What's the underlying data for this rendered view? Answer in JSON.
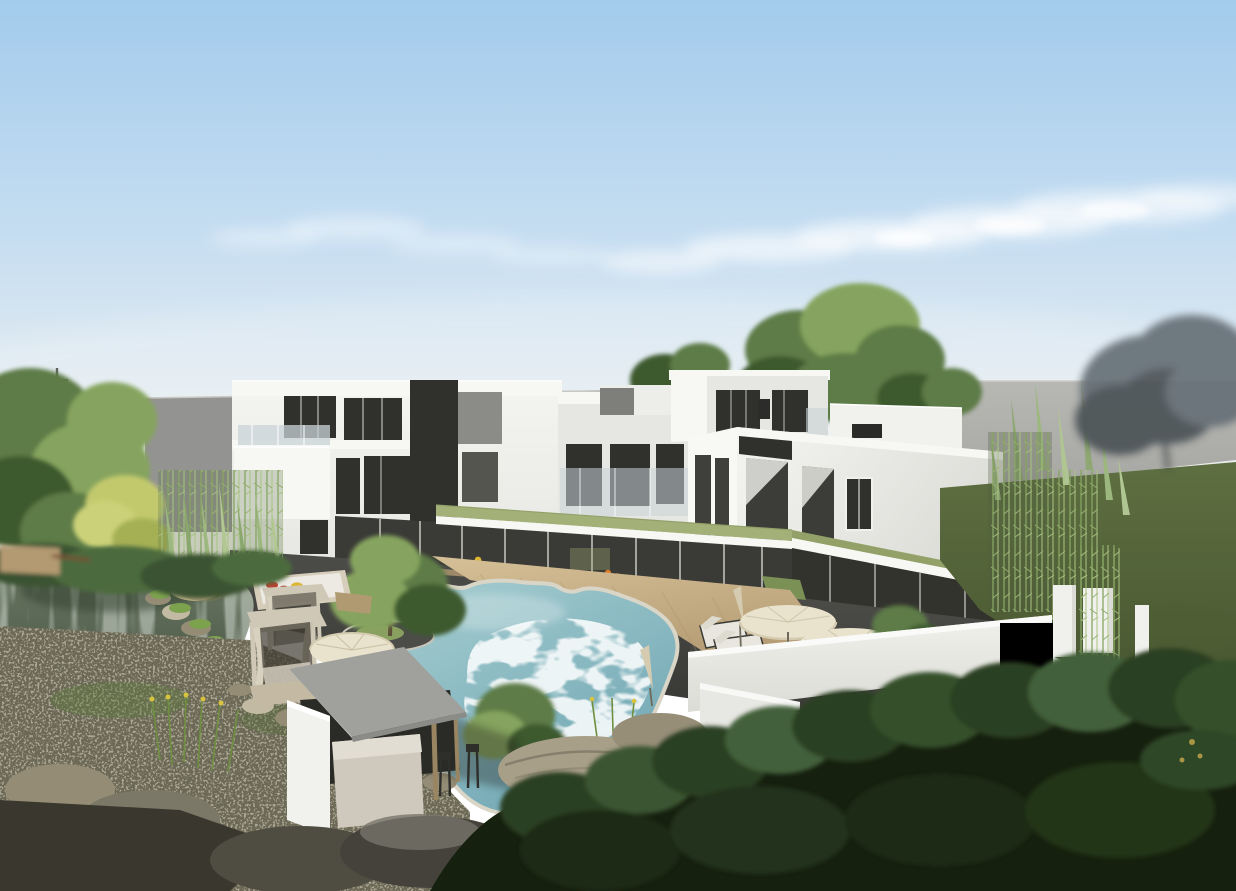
{
  "meta": {
    "kind": "architectural-rendering",
    "description": "Aerial 3D visualization of a modern white multi-wing residence around a courtyard: freeform swimming pool with wooden deck, glass colonnade with sage green roof, koi pond with rock garden at left, gazebo pool bar, cabana daybeds, cream patio umbrellas and sun loungers, white perimeter wall, dense foreground trees, gray backdrop buildings under a clear blue sky"
  },
  "scene": {
    "objects": [
      {
        "name": "sky",
        "label": "gradient blue sky"
      },
      {
        "name": "clouds",
        "label": "wispy white clouds"
      },
      {
        "name": "utility-pole",
        "label": "distant utility pole"
      },
      {
        "name": "backdrop-building-left",
        "label": "gray neighboring building"
      },
      {
        "name": "backdrop-wall-right",
        "label": "large gray boundary wall"
      },
      {
        "name": "misty-tree",
        "label": "hazy tree at far right"
      },
      {
        "name": "left-garden-trees",
        "label": "lush garden trees"
      },
      {
        "name": "yellow-accent-tree",
        "label": "yellow-green accent tree"
      },
      {
        "name": "bamboo-grove",
        "label": "bamboo grove"
      },
      {
        "name": "conifer-grove",
        "label": "slender conifers"
      },
      {
        "name": "left-wing",
        "label": "three-story white wing"
      },
      {
        "name": "penthouse",
        "label": "rooftop penthouse volume"
      },
      {
        "name": "center-block",
        "label": "recessed center block with balcony"
      },
      {
        "name": "right-wing",
        "label": "two-story white wing"
      },
      {
        "name": "glass-colonnade",
        "label": "ground-floor glass colonnade"
      },
      {
        "name": "green-roof",
        "label": "sage green walkway roof"
      },
      {
        "name": "courtyard-paving",
        "label": "dark stone paving"
      },
      {
        "name": "wood-deck",
        "label": "timber pool deck"
      },
      {
        "name": "swimming-pool",
        "label": "freeform turquoise pool"
      },
      {
        "name": "pool-island-tree",
        "label": "planted island tree in pool corner"
      },
      {
        "name": "koi-pond",
        "label": "reflective garden pond"
      },
      {
        "name": "pond-stones",
        "label": "shore stones"
      },
      {
        "name": "reeds",
        "label": "reeds with yellow blooms"
      },
      {
        "name": "stepping-stones",
        "label": "stepping stone path"
      },
      {
        "name": "gazebo-bar",
        "label": "flat-roof gazebo bar"
      },
      {
        "name": "cabana-daybeds",
        "label": "curtained cabana daybeds"
      },
      {
        "name": "daybed-platform",
        "label": "daybed with red and yellow pillows"
      },
      {
        "name": "patio-umbrellas",
        "label": "cream patio umbrellas"
      },
      {
        "name": "sun-loungers",
        "label": "poolside loungers"
      },
      {
        "name": "perimeter-wall",
        "label": "white perimeter wall"
      },
      {
        "name": "gate-pillars",
        "label": "white gate pillars"
      },
      {
        "name": "lawn",
        "label": "olive lawn slope"
      },
      {
        "name": "foreground-forest",
        "label": "dense dark foreground trees"
      },
      {
        "name": "boulders",
        "label": "landscape boulders and rocks"
      }
    ]
  },
  "colors": {
    "sky_top": "#a3cbec",
    "sky_mid": "#c7def1",
    "sky_low": "#e9eef0",
    "sky_horizon": "#f4f0e7",
    "cloud_white": "#ffffff",
    "backdrop_building": "#939391",
    "backdrop_building_light": "#9e9e9b",
    "backdrop_wall": "#b7b7b3",
    "backdrop_wall_dark": "#a6a6a2",
    "facade_white": "#f4f4f1",
    "facade_shade": "#e6e6e2",
    "facade_side": "#d9d9d4",
    "fascia_white": "#f7f7f4",
    "window_dark": "#30302d",
    "window_mid": "#55554f",
    "glass_railing": "#c9d3d7",
    "green_roof": "#a3b077",
    "green_roof_dark": "#93a169",
    "pool_shallow": "#a7ced1",
    "pool_deep": "#71a7b4",
    "pool_foam": "#f2f8f6",
    "pool_coping": "#d9d5c7",
    "deck_light": "#d6c097",
    "deck_dark": "#b39a72",
    "paving": "#4c4c49",
    "paving_dark": "#3a3a37",
    "pond_light": "#6d7c66",
    "pond_dark": "#3e483b",
    "pond_reflection": "#b6c2b4",
    "stone_light": "#c2baa2",
    "stone_mid": "#948c75",
    "stone_dark": "#5e5a49",
    "ground": "#6b6855",
    "ground_dark": "#3a382e",
    "grass": "#5e6f41",
    "grass_dark": "#47552f",
    "foliage_light": "#86a45e",
    "foliage": "#5d7c47",
    "foliage_dark": "#3c5a2e",
    "forest": "#2b3f23",
    "forest_dark": "#16200f",
    "bamboo": "#8fac6c",
    "conifer": "#9db87f",
    "accent_yellow_tree": "#c2c96d",
    "misty_tree": "#667077",
    "misty_tree_dark": "#4b5356",
    "trunk": "#5c4f38",
    "wood_post": "#9a8563",
    "gazebo_roof": "#a0a09d",
    "gazebo_roof_light": "#c0c0bd",
    "umbrella": "#e9e2cd",
    "umbrella_shade": "#d4cbb0",
    "cabana": "#cfc8b6",
    "wall_white": "#f0f0ec",
    "wall_shade": "#dcdcd6",
    "pillow_red": "#c2402e",
    "pillow_yellow": "#ddb535",
    "float_orange": "#e07b28"
  }
}
